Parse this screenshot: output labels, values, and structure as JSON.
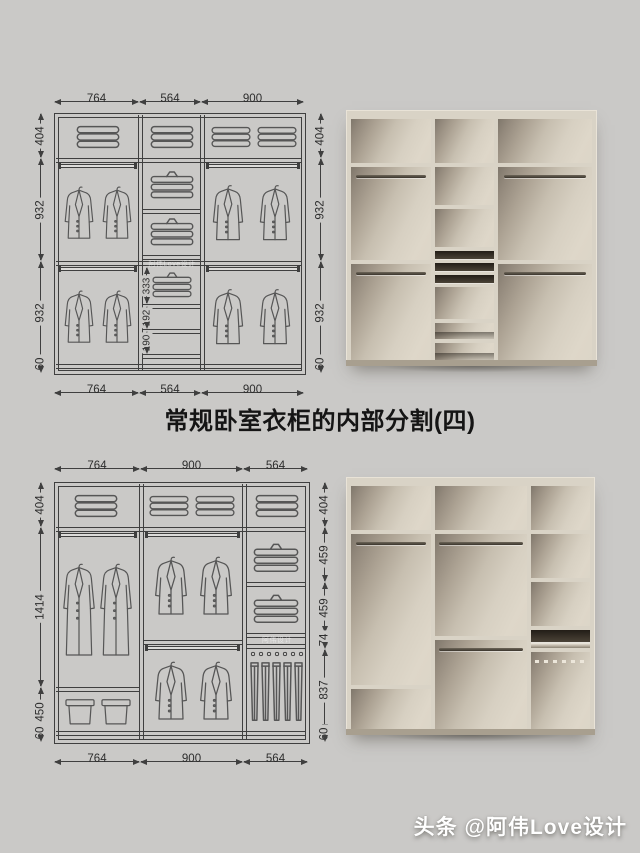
{
  "title": "常规卧室衣柜的内部分割(四)",
  "brand_watermark": "头条 @阿伟Love设计",
  "diagram_top": {
    "top_dims": [
      "764",
      "564",
      "900"
    ],
    "bottom_dims": [
      "764",
      "564",
      "900"
    ],
    "left_dims": [
      "404",
      "932",
      "932",
      "60"
    ],
    "right_dims": [
      "404",
      "932",
      "932",
      "60"
    ],
    "inner_dims": [
      "333",
      "192",
      "190"
    ],
    "watermark": "阿伟Love设计"
  },
  "diagram_bottom": {
    "top_dims": [
      "764",
      "900",
      "564"
    ],
    "bottom_dims": [
      "764",
      "900",
      "564"
    ],
    "left_dims": [
      "404",
      "1414",
      "450",
      "60"
    ],
    "right_dims": [
      "404",
      "459",
      "459",
      "74",
      "837",
      "60"
    ],
    "watermark": "阿伟设计"
  },
  "colors": {
    "page_bg": "#cac9c7",
    "line": "#3f3f3f",
    "cabinet_panel": "#d9d3c6",
    "cabinet_back": "#ddd7c9",
    "cabinet_shadow": "#7f776b",
    "title": "#151515",
    "watermark": "#ffffff"
  }
}
